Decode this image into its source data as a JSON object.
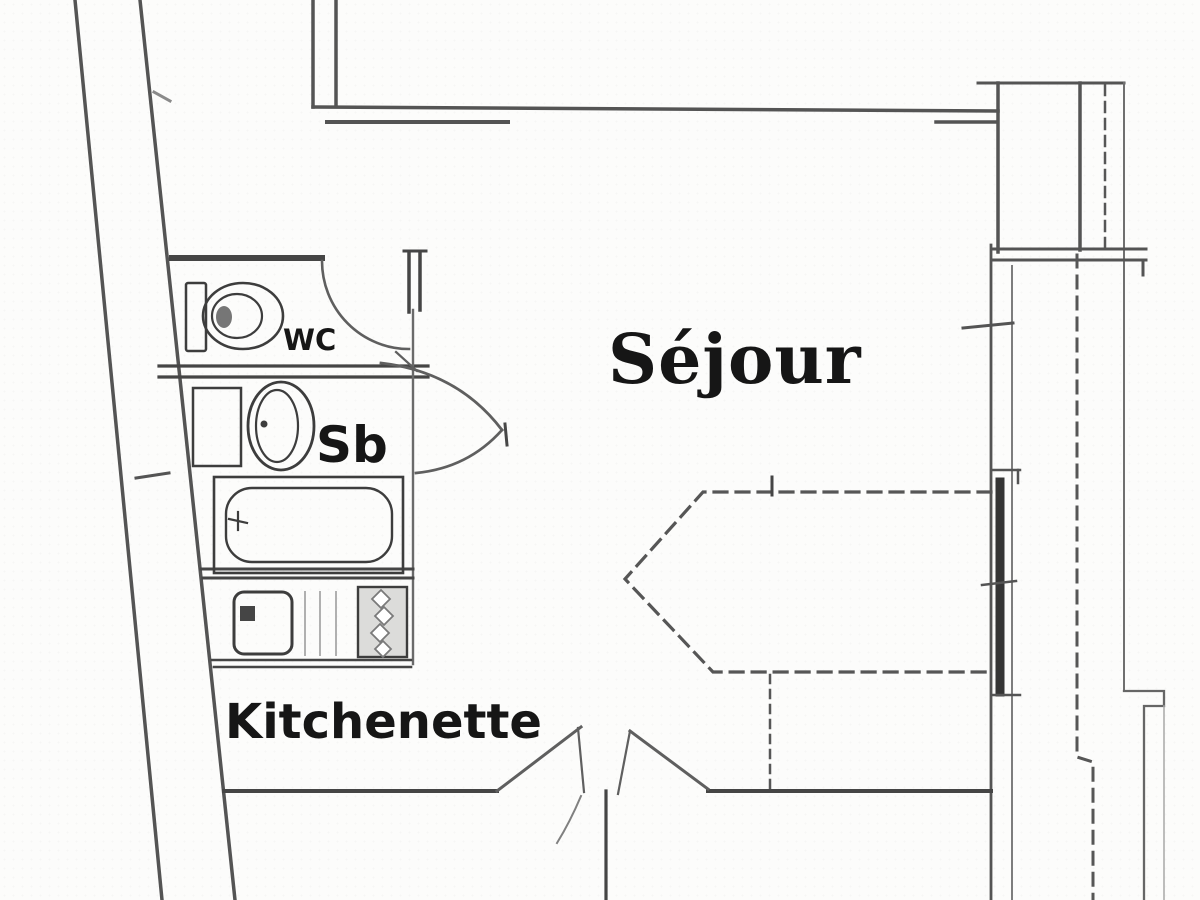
{
  "plan": {
    "kind": "apartment floor plan (scanned drawing)",
    "rooms": [
      {
        "key": "sejour",
        "label": "Séjour"
      },
      {
        "key": "sb",
        "label": "Sb"
      },
      {
        "key": "wc",
        "label": "WC"
      },
      {
        "key": "kitchenette",
        "label": "Kitchenette"
      }
    ],
    "fixtures_visible": [
      "toilet",
      "washbasin",
      "bathroom-cabinet",
      "bathtub",
      "kitchen-sink",
      "stove-burners",
      "folding-bed-dashed-outline",
      "double-entry-door",
      "wc-door-swing",
      "bathroom-door-swing",
      "window-glazing-right-wall",
      "balcony-dashed-line"
    ]
  },
  "labels": {
    "sejour": "Séjour",
    "sb": "Sb",
    "wc": "WC",
    "kitchenette": "Kitchenette"
  },
  "colors": {
    "wall": "#545454",
    "wall_dark": "#454545",
    "wall_light": "#787878",
    "fixture": "#3d3d3d",
    "dashed": "#565656",
    "glazing": "#353535",
    "door": "#5f5f5f",
    "text": "#161616",
    "background": "#fcfcfb",
    "stove_fill": "#dcdcda"
  }
}
